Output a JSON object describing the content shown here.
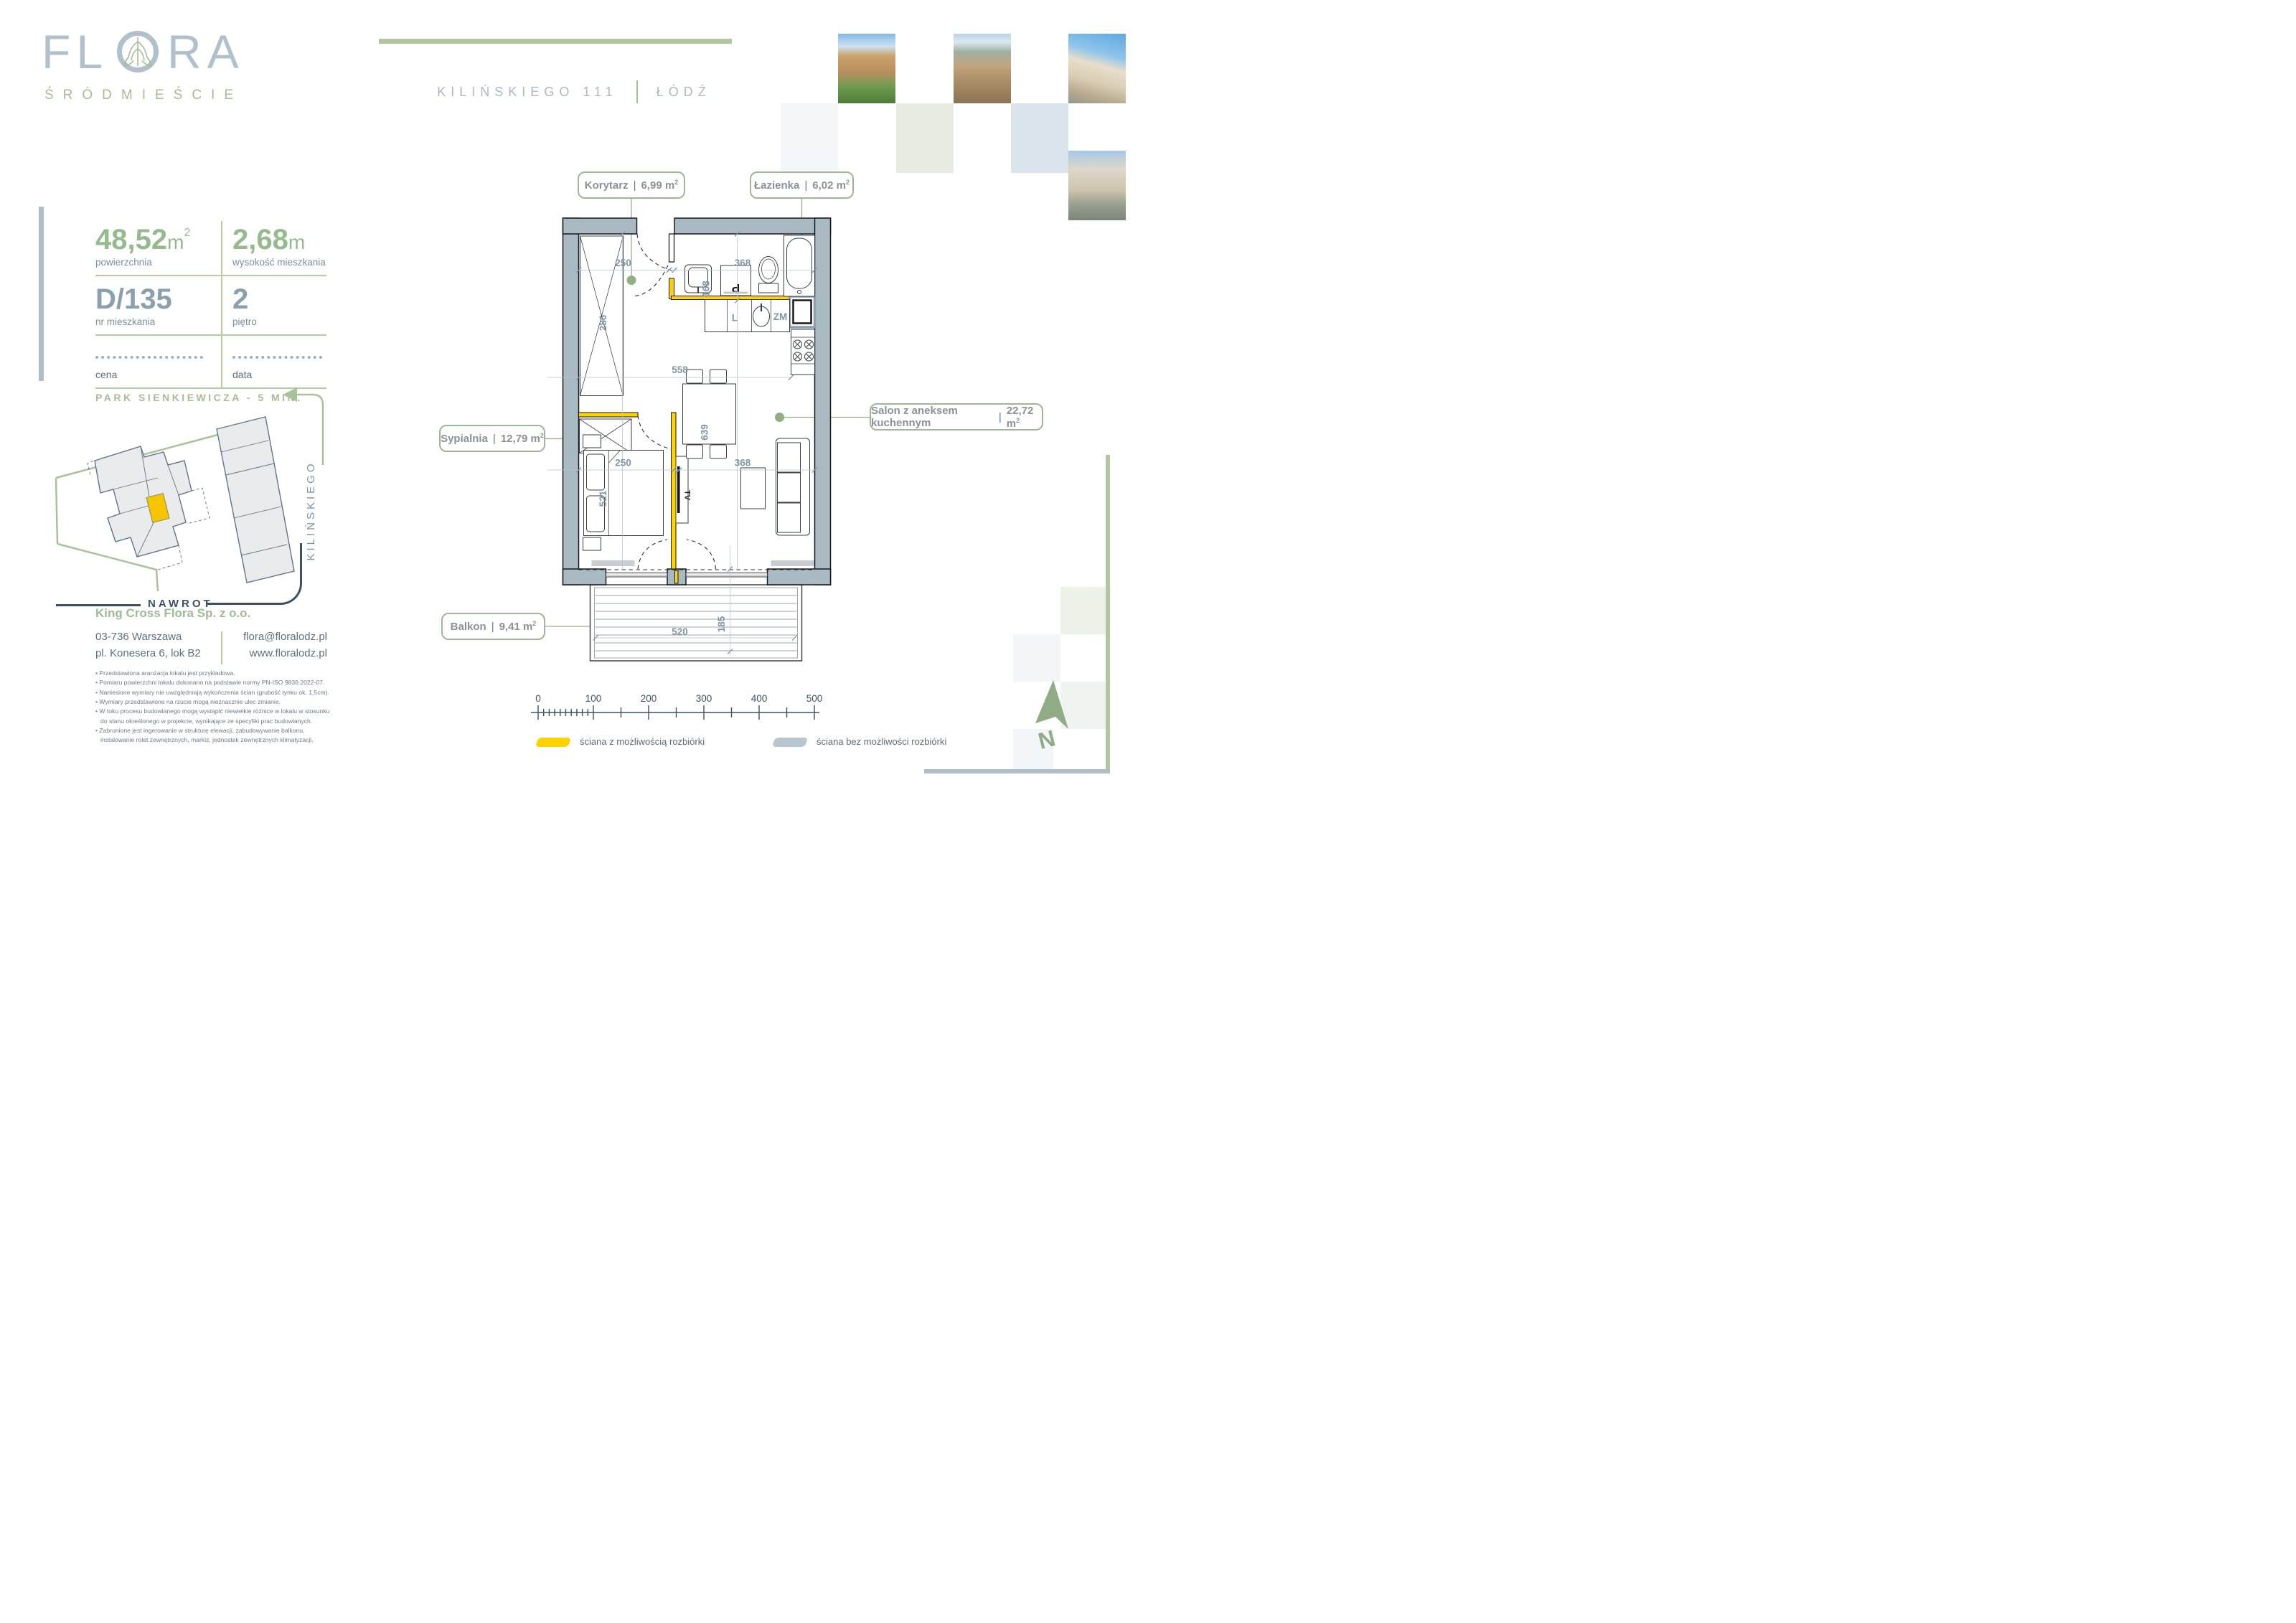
{
  "brand": {
    "logo_fl": "FL",
    "logo_ra": "RA",
    "subtitle": "ŚRÓDMIEŚCIE"
  },
  "header": {
    "address": "KILIŃSKIEGO 111",
    "city": "ŁÓDŹ"
  },
  "stats": {
    "area_value": "48,52",
    "area_unit": "m",
    "area_sup": "2",
    "area_label": "powierzchnia",
    "height_value": "2,68",
    "height_unit": "m",
    "height_label": "wysokość mieszkania",
    "unit_number": "D/135",
    "unit_label": "nr mieszkania",
    "floor_value": "2",
    "floor_label": "piętro",
    "price_label": "cena",
    "date_label": "data"
  },
  "park_note": "PARK SIENKIEWICZA - 5 MIN.",
  "map": {
    "street_side": "KILIŃSKIEGO",
    "street_bottom": "NAWROT"
  },
  "company": {
    "name": "King Cross Flora Sp. z o.o.",
    "postal_city": "03-736  Warszawa",
    "street": "pl. Konesera 6, lok B2",
    "email": "flora@floralodz.pl",
    "website": "www.floralodz.pl"
  },
  "disclaimer": [
    "• Przedstawiona aranżacja lokalu jest przykładowa.",
    "• Pomiaru powierzchni lokalu dokonano na podstawie normy PN-ISO 9836:2022-07.",
    "• Naniesione wymiary nie uwzględniają wykończenia ścian (grubość tynku ok. 1,5cm).",
    "• Wymiary przedstawione na rzucie mogą nieznacznie ulec zmianie.",
    "• W toku procesu budowlanego mogą wystąpić niewielkie różnice w lokalu w stosunku do stanu określonego w projekcie, wynikające ze specyfiki prac budowlanych.",
    "• Zabronione jest ingerowanie w strukturę elewacji, zabudowywanie balkonu, instalowanie rolet zewnętrznych, markiz, jednostek zewnętrznych klimatyzacji."
  ],
  "plan": {
    "label_separator": "|",
    "rooms": [
      {
        "name": "Korytarz",
        "area": "6,99 m",
        "sup": "2"
      },
      {
        "name": "Łazienka",
        "area": "6,02 m",
        "sup": "2"
      },
      {
        "name": "Sypialnia",
        "area": "12,79 m",
        "sup": "2"
      },
      {
        "name": "Salon z aneksem kuchennym",
        "area": "22,72 m",
        "sup": "2"
      },
      {
        "name": "Balkon",
        "area": "9,41 m",
        "sup": "2"
      }
    ],
    "dims": {
      "hall_width": "250",
      "hall_depth": "286",
      "bath_depth": "168",
      "bath_width": "368",
      "total_width": "558",
      "bedroom_width": "250",
      "bedroom_length": "521",
      "living_width": "368",
      "living_length": "639",
      "balcony_width": "520",
      "balcony_depth": "185"
    },
    "fixtures": {
      "fridge": "L",
      "dishwasher": "ZM",
      "tv": "TV",
      "washer": "P"
    },
    "north": "N"
  },
  "scalebar": {
    "labels": [
      "0",
      "100",
      "200",
      "300",
      "400",
      "500"
    ]
  },
  "legend": {
    "demolishable": {
      "color": "#ffd200",
      "label": "ściana z możliwością rozbiórki"
    },
    "structural": {
      "color": "#b9c6cf",
      "label": "ściana bez możliwości rozbiórki"
    }
  },
  "colors": {
    "accent_green": "#9fb796",
    "brand_green": "#a6bd94",
    "brand_gray": "#b0c1cc",
    "text_gray": "#5d7182",
    "wall_gray": "#a9bac3",
    "dim_blue": "#8096a6",
    "navy": "#3e5064",
    "highlight_yellow": "#f7c500"
  }
}
